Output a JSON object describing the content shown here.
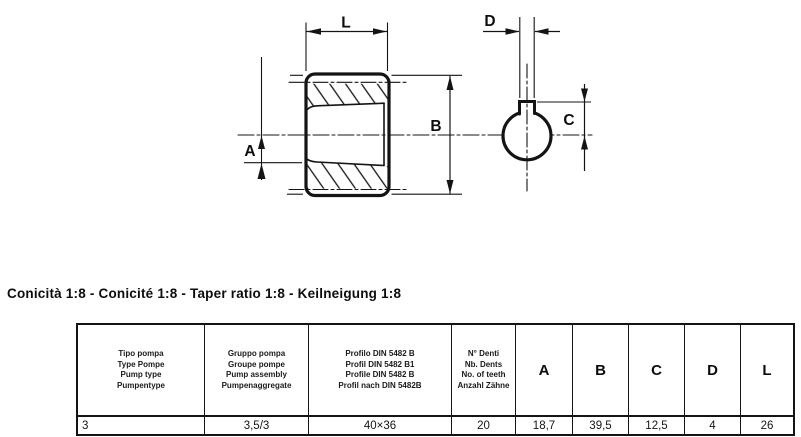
{
  "title": "Conicità 1:8 - Conicité 1:8 - Taper ratio 1:8 - Keilneigung 1:8",
  "drawing": {
    "dim_labels": {
      "L": "L",
      "A": "A",
      "B": "B",
      "C": "C",
      "D": "D"
    }
  },
  "table": {
    "headers": {
      "pump_type": [
        "Tipo pompa",
        "Type Pompe",
        "Pump type",
        "Pumpentype"
      ],
      "pump_assembly": [
        "Gruppo pompa",
        "Groupe pompe",
        "Pump assembly",
        "Pumpenaggregate"
      ],
      "profile": [
        "Profilo DIN 5482 B",
        "Profil DIN 5482 B1",
        "Profile DIN 5482 B",
        "Profil nach DIN 5482B"
      ],
      "teeth": [
        "N° Denti",
        "Nb. Dents",
        "No. of teeth",
        "Anzahl Zähne"
      ],
      "dims": [
        "A",
        "B",
        "C",
        "D",
        "L"
      ]
    },
    "row": {
      "pump_type": "3",
      "pump_assembly": "3,5/3",
      "profile": "40×36",
      "teeth": "20",
      "A": "18,7",
      "B": "39,5",
      "C": "12,5",
      "D": "4",
      "L": "26"
    }
  }
}
